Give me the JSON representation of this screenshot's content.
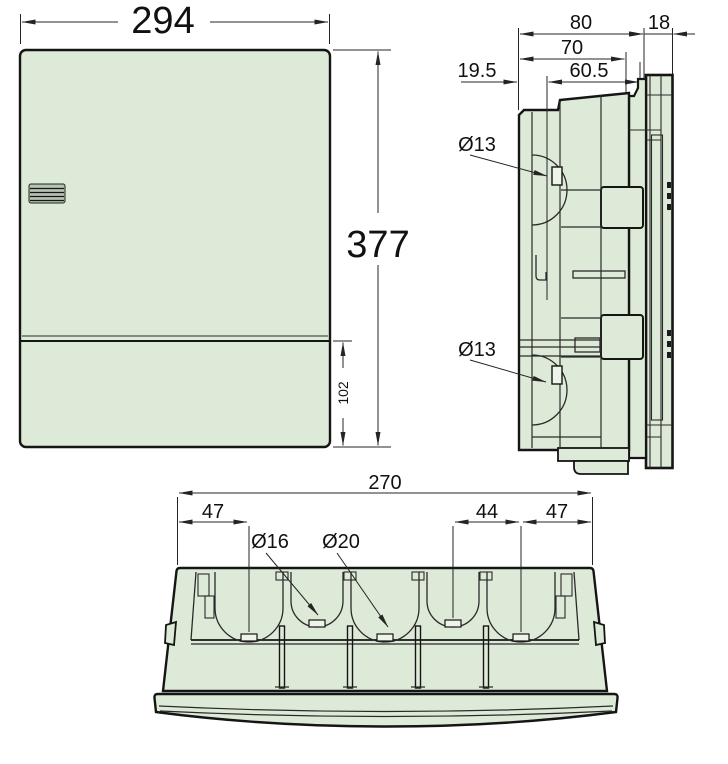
{
  "colors": {
    "body_fill": "#deead8",
    "tab_fill": "#eef4ea",
    "vent_fill": "#b7c2b1",
    "outline": "#151515",
    "inner_line": "#2a2a2a",
    "dim_line": "#242424",
    "text": "#111111"
  },
  "front_view": {
    "width": "294",
    "height": "377",
    "lower_section_height": "102"
  },
  "side_view": {
    "depth_overall": "80",
    "front_protrusion": "18",
    "depth_inner": "70",
    "back_offset": "19.5",
    "inner_offset": "60.5",
    "knockout_upper": "Ø13",
    "knockout_lower": "Ø13"
  },
  "bottom_view": {
    "width_overall": "270",
    "edge_to_first_knockout": "47",
    "knockout_spacing": "44",
    "last_knockout_to_edge": "47",
    "knockout_small": "Ø16",
    "knockout_large": "Ø20"
  }
}
